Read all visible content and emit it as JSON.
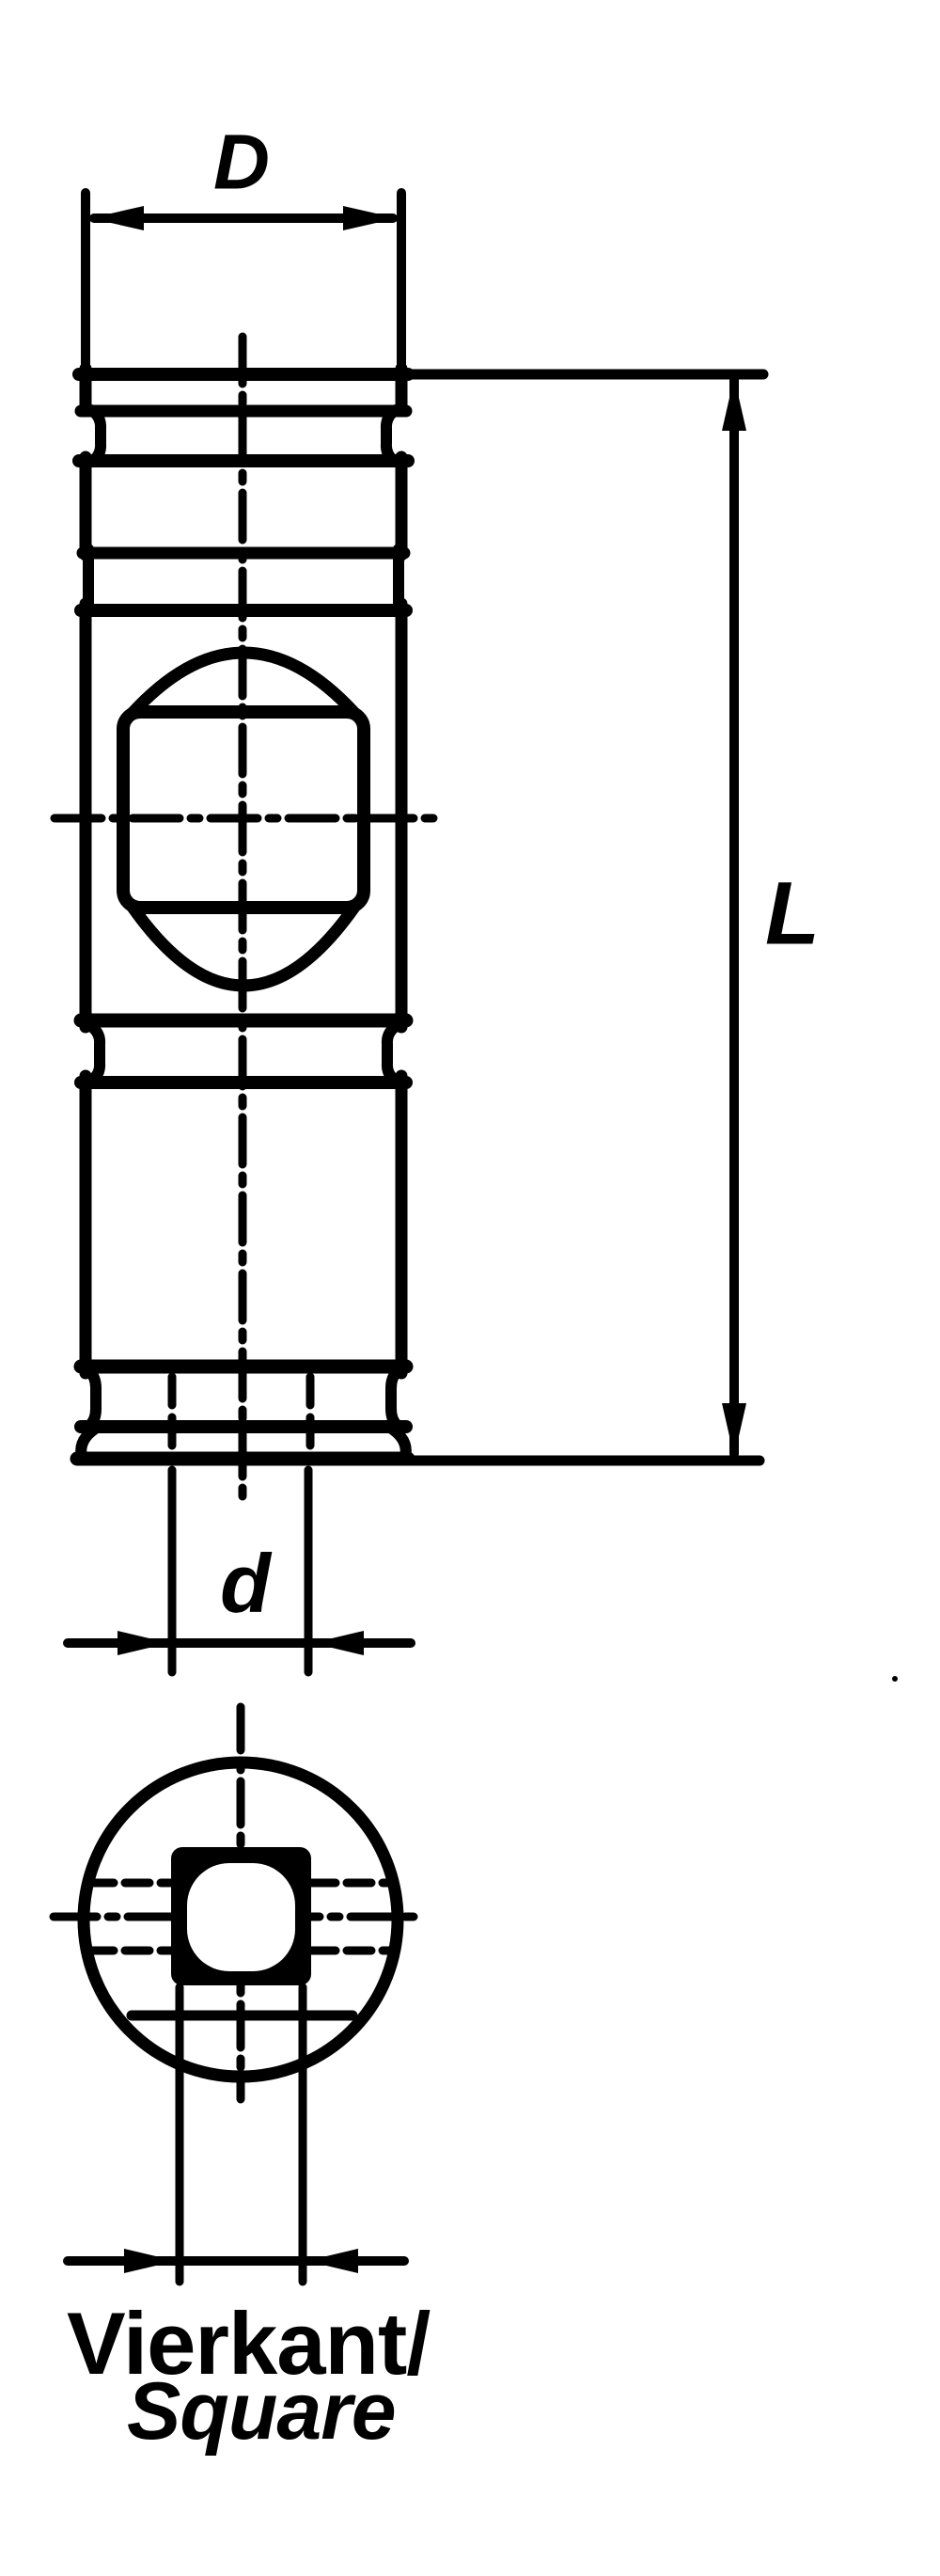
{
  "document": {
    "type": "technical-drawing",
    "subject": "cylindrical socket adapter with square drive hole, front view and bottom view",
    "ink_color": "#000000",
    "paper_color": "#ffffff"
  },
  "labels": {
    "outer_diameter": "D",
    "overall_length": "L",
    "square_size": "d",
    "caption_german": "Vierkant/",
    "caption_english": "Square"
  },
  "views": {
    "front_view": "cylinder with ball section and square through-hole",
    "bottom_view": "circle with square drive opening"
  }
}
